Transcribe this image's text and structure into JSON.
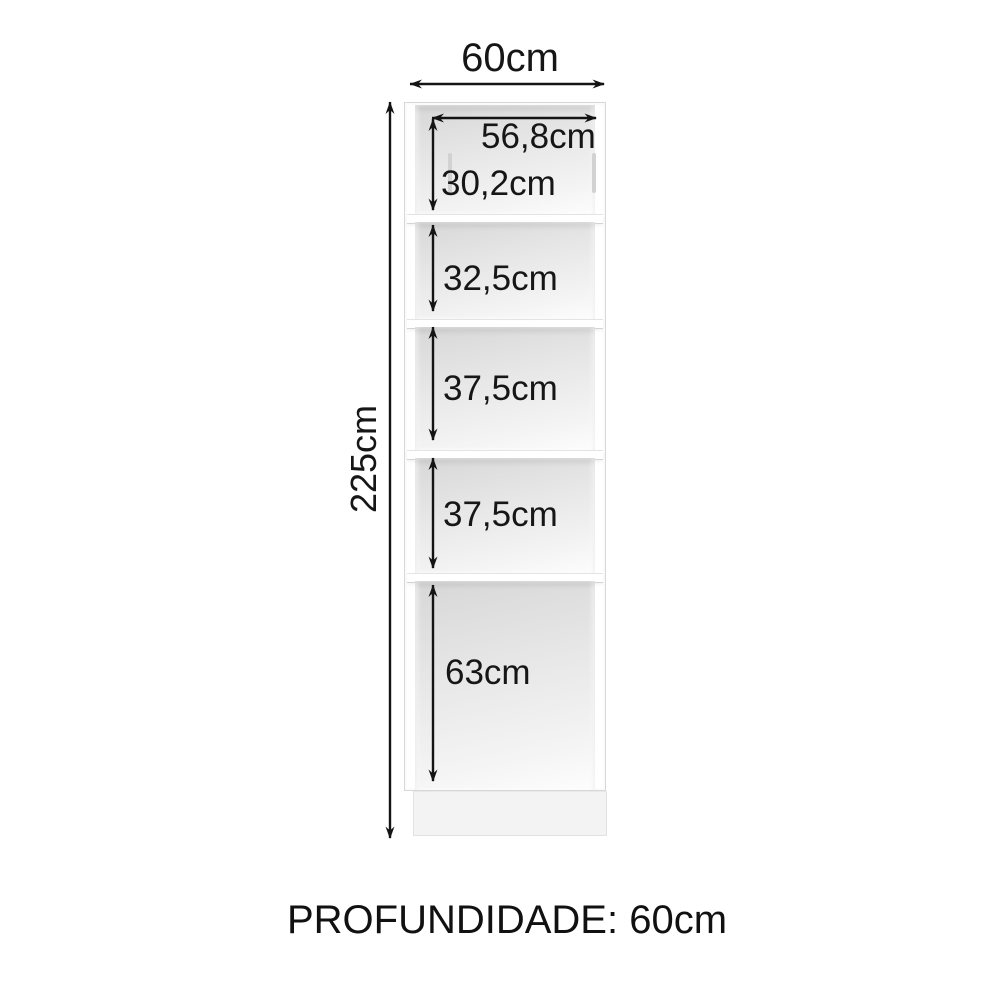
{
  "diagram": {
    "subject": "tall-cabinet-dimension-diagram",
    "outer_width_label": "60cm",
    "total_height_label": "225cm",
    "inner_width_label": "56,8cm",
    "depth_note": "PROFUNDIDADE: 60cm"
  },
  "compartments": [
    {
      "label": "30,2cm"
    },
    {
      "label": "32,5cm"
    },
    {
      "label": "37,5cm"
    },
    {
      "label": "37,5cm"
    },
    {
      "label": "63cm"
    }
  ],
  "colors": {
    "line": "#141414",
    "cabinet_border": "#d7d7d7",
    "panel_dark": "#d7d7d7",
    "panel_light": "#fdfdfd",
    "base_fill": "#f3f3f3",
    "background": "#ffffff"
  }
}
